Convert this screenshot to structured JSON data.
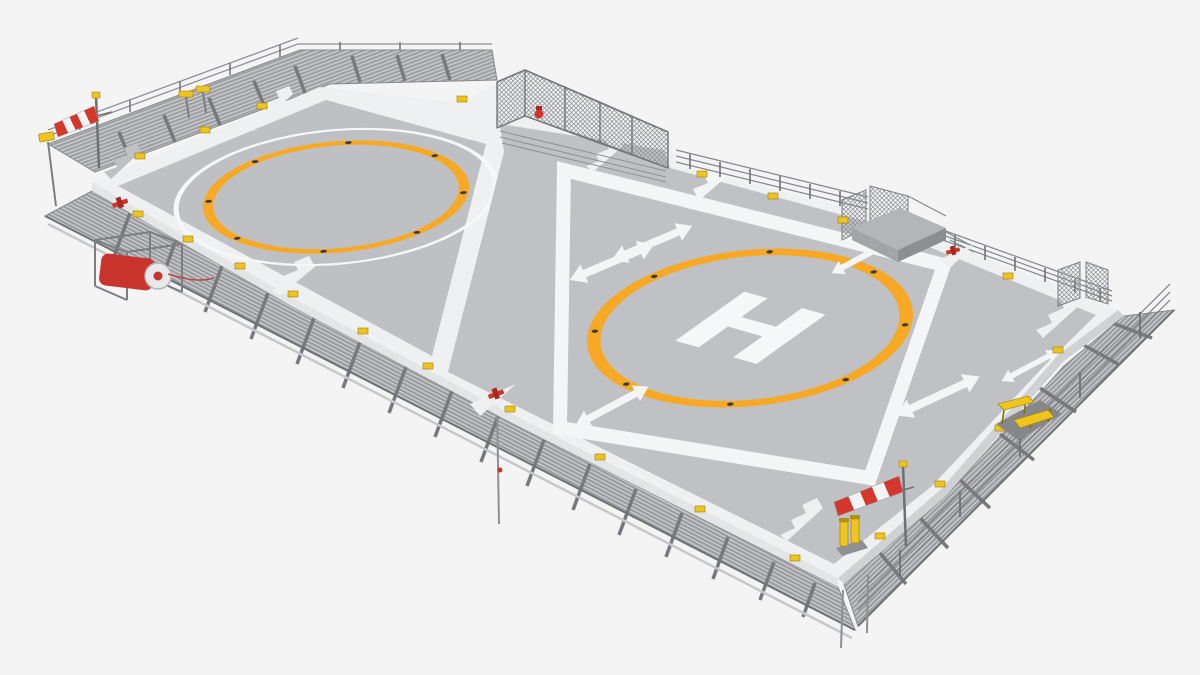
{
  "scene": {
    "subject": "Helideck 3D render — twin helipad platform",
    "description": "Elevated three-quarter 3D render of an aluminium helideck with two landing zones, perimeter grating walkways, safety fences, windsocks, floodlights and fire-fighting equipment",
    "background_color": "#f4f4f5"
  },
  "palette": {
    "deck_white": "#eff0f1",
    "pad_gray": "#bec0c3",
    "marking_white": "#f6f7f8",
    "marking_orange": "#f7a925",
    "safety_yellow": "#eec41d",
    "alert_red": "#cf3429",
    "metal_gray": "#9b9da1",
    "walkway_gray": "#97999d"
  },
  "markings": {
    "h_symbol": "H",
    "left_pad": {
      "name": "left-landing-zone",
      "outer_circle": "white touchdown circle",
      "inner_circle": "orange positioning circle",
      "tie_down_dots": 8
    },
    "right_pad": {
      "name": "right-landing-zone",
      "circle": "orange touchdown circle",
      "center_symbol": "white H",
      "clearance_arrows": 6,
      "tie_down_dots": 8
    }
  },
  "equipment": {
    "windsocks": [
      {
        "position": "north-west corner",
        "colors": [
          "red",
          "white"
        ]
      },
      {
        "position": "south corner",
        "colors": [
          "red",
          "white"
        ]
      }
    ],
    "perimeter_lights": {
      "color": "yellow",
      "count_visible": 22
    },
    "floodlights": [
      "twin floodlight north edge",
      "corner floodlight north-west",
      "twin floodlight south corner",
      "floodlight rack east walkway"
    ],
    "fire_fighting": [
      "fire hose reel cabinet (red)",
      "fire extinguisher at fence (red)",
      "deluge nozzles (red)"
    ],
    "structures": [
      "mesh safety fence north",
      "access platform north-east",
      "mesh panels east corner",
      "perimeter guard railings",
      "aluminium grating walkways"
    ]
  }
}
